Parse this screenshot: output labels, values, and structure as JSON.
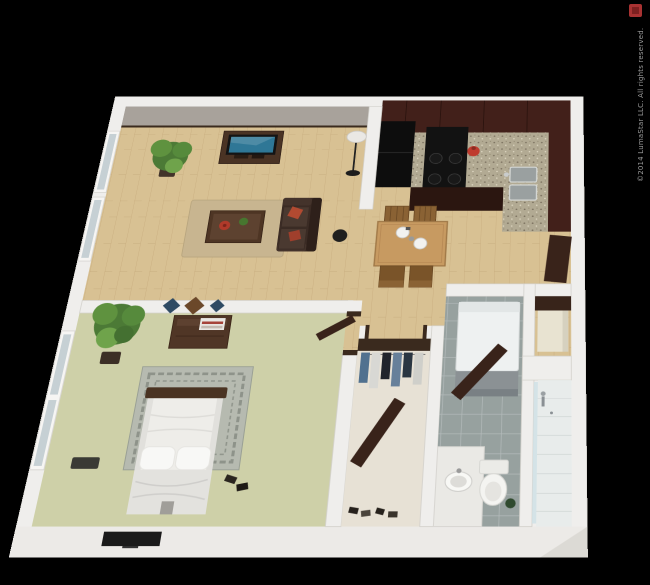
{
  "meta": {
    "description": "3D rendered one-bedroom apartment floor plan on black background"
  },
  "watermark": {
    "text": "©2014 LumaStar LLC. All rights reserved.",
    "color": "#9b9b9b"
  },
  "logo_mark": {
    "color": "#a83232"
  },
  "colors": {
    "background": "#000000",
    "wall": "#efeeec",
    "wall_face": "#a8a29b",
    "wood_floor": "#d8c193",
    "carpet": "#ced0a8",
    "closet_floor": "#e7e1d5",
    "tile": "#97a19f",
    "shower_floor": "#e8eceb",
    "cabinet": "#42201a",
    "granite_base": "#b2aa93",
    "appliance_black": "#0d0d0d",
    "appliance_white": "#eef1f1",
    "sofa": "#3b2b24",
    "cushion_red": "#b14a31",
    "rug_living": "#c8b590",
    "rug_bedroom": "#b6bab0",
    "bedding": "#eeede9",
    "table_wood": "#c79a61",
    "door_wood": "#39231a",
    "tv_screen": "#2f7796",
    "plant_green": "#4c7a36",
    "accent_red": "#bf3b2e"
  },
  "rooms": [
    {
      "id": "living-room",
      "floor": "hardwood",
      "furniture": [
        "potted-plant",
        "tv-stand",
        "flat-screen-tv",
        "area-rug",
        "coffee-table",
        "sofa",
        "throw-pillows",
        "floor-lamp",
        "speaker"
      ]
    },
    {
      "id": "kitchen",
      "floor": "hardwood",
      "furniture": [
        "upper-cabinets",
        "refrigerator",
        "range",
        "granite-counter",
        "double-sink",
        "red-kettle"
      ]
    },
    {
      "id": "dining-area",
      "floor": "hardwood",
      "furniture": [
        "dining-table",
        "four-chairs",
        "place-settings"
      ]
    },
    {
      "id": "bedroom",
      "floor": "carpet",
      "furniture": [
        "dresser",
        "wall-art",
        "potted-plant",
        "area-rug",
        "bed",
        "pillows",
        "shoes",
        "wall-tv",
        "window"
      ]
    },
    {
      "id": "walk-in-closet",
      "floor": "linoleum",
      "furniture": [
        "hanging-clothes",
        "closet-door",
        "shoes"
      ]
    },
    {
      "id": "bathroom",
      "floor": "tile",
      "furniture": [
        "vanity-sink",
        "toilet",
        "open-door",
        "shower"
      ]
    },
    {
      "id": "utility",
      "floor": "tile",
      "furniture": [
        "washer-dryer",
        "linen-shelves",
        "entry-door"
      ]
    }
  ]
}
